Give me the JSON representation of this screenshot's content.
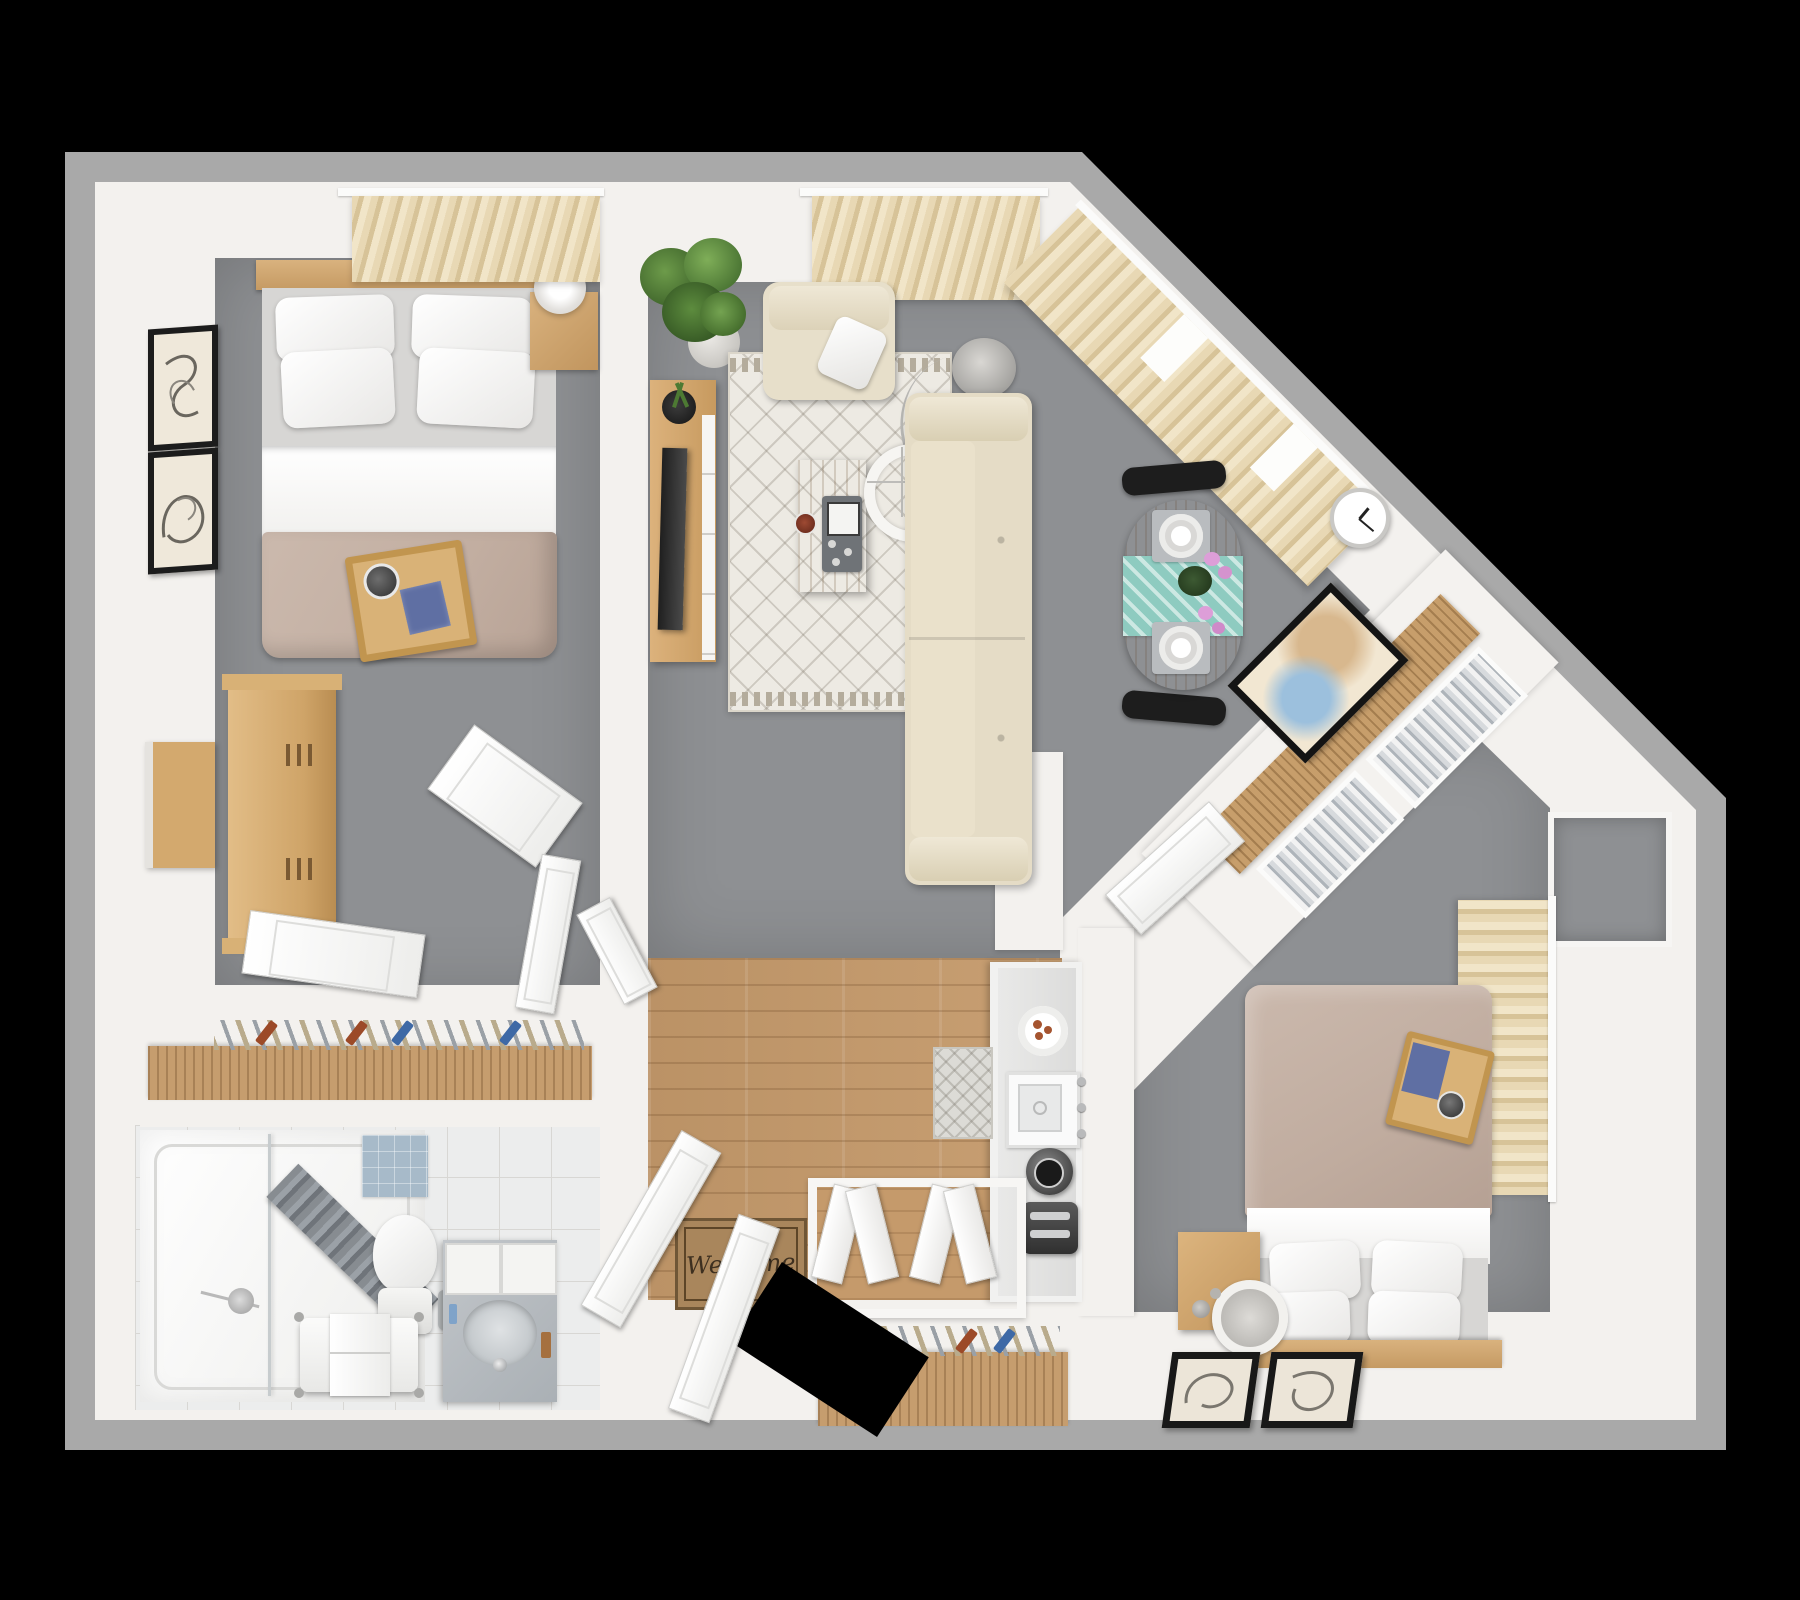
{
  "title": "Two-bedroom apartment 3D floor plan, top-down view",
  "palette": {
    "background": "#000000",
    "outer_wall": "#a9a9a9",
    "wall": "#f3f1ee",
    "carpet": "#8e9093",
    "wood_floor": "#c59a6b",
    "furniture_wood": "#c79e6b",
    "curtain_beige": "#e3d2ae",
    "duvet_taupe": "#c3b0a3",
    "linen_white": "#ffffff",
    "sofa_beige": "#e5dcc6",
    "runner_teal": "#8ecbc0",
    "accent_rust": "#a5542f",
    "accent_blue": "#5f6fa3",
    "shower_curtain_grey": "#878c91"
  },
  "entry": {
    "welcome_mat_text": "Welcome",
    "items": [
      "front-door",
      "welcome-mat",
      "bifold-closet-doors",
      "coat-closet-hangers",
      "wood-plank-floor"
    ]
  },
  "rooms": [
    {
      "name": "bedroom-1",
      "floor": "grey carpet",
      "items": [
        "double-bed",
        "4 white pillows",
        "taupe duvet",
        "breakfast tray with cup and blue book",
        "wood headboard",
        "nightstand with lamp",
        "tall dresser",
        "wall desk panel",
        "2 framed wall art",
        "beige curtains",
        "closet rod with hangers",
        "closet doors"
      ]
    },
    {
      "name": "living-dining",
      "floor": "grey carpet",
      "items": [
        "corner potted plant",
        "tv console with tv and plant",
        "beige armchair with white pillow",
        "patterned area rug",
        "wood coffee table with game tray and coaster",
        "arc floor lamp",
        "beige sofa",
        "round dining table",
        "teal table runner",
        "2 place settings",
        "pink orchid centerpiece",
        "2 black chairs",
        "wall clock",
        "beige curtains along top and diagonal window walls"
      ]
    },
    {
      "name": "hall-closet-corridor",
      "floor": "white",
      "items": [
        "diagonal wardrobe rod",
        "wire shelves with clothes",
        "framed artwork",
        "door to bedroom-2"
      ]
    },
    {
      "name": "kitchen",
      "floor": "wood",
      "items": [
        "counter strip",
        "plate of food",
        "square sink with faucet",
        "kettle",
        "toaster",
        "patterned runner rug"
      ]
    },
    {
      "name": "bathroom",
      "floor": "tile",
      "items": [
        "shower tub with glass panel",
        "grey shower curtain",
        "shower head",
        "blue bath mat",
        "toilet",
        "waste bin",
        "bench with towel",
        "vanity with oval sink and faucet"
      ]
    },
    {
      "name": "bedroom-2",
      "floor": "grey carpet",
      "items": [
        "double-bed with headboard at bottom",
        "4 white pillows",
        "taupe duvet",
        "breakfast tray with blue book and cup",
        "nightstand with ring lamp and spheres",
        "beige curtains on right wall",
        "window",
        "2 framed art pieces on lower wall"
      ]
    }
  ],
  "counts": {
    "bedrooms": 2,
    "bathrooms": 1,
    "closets": 4
  }
}
